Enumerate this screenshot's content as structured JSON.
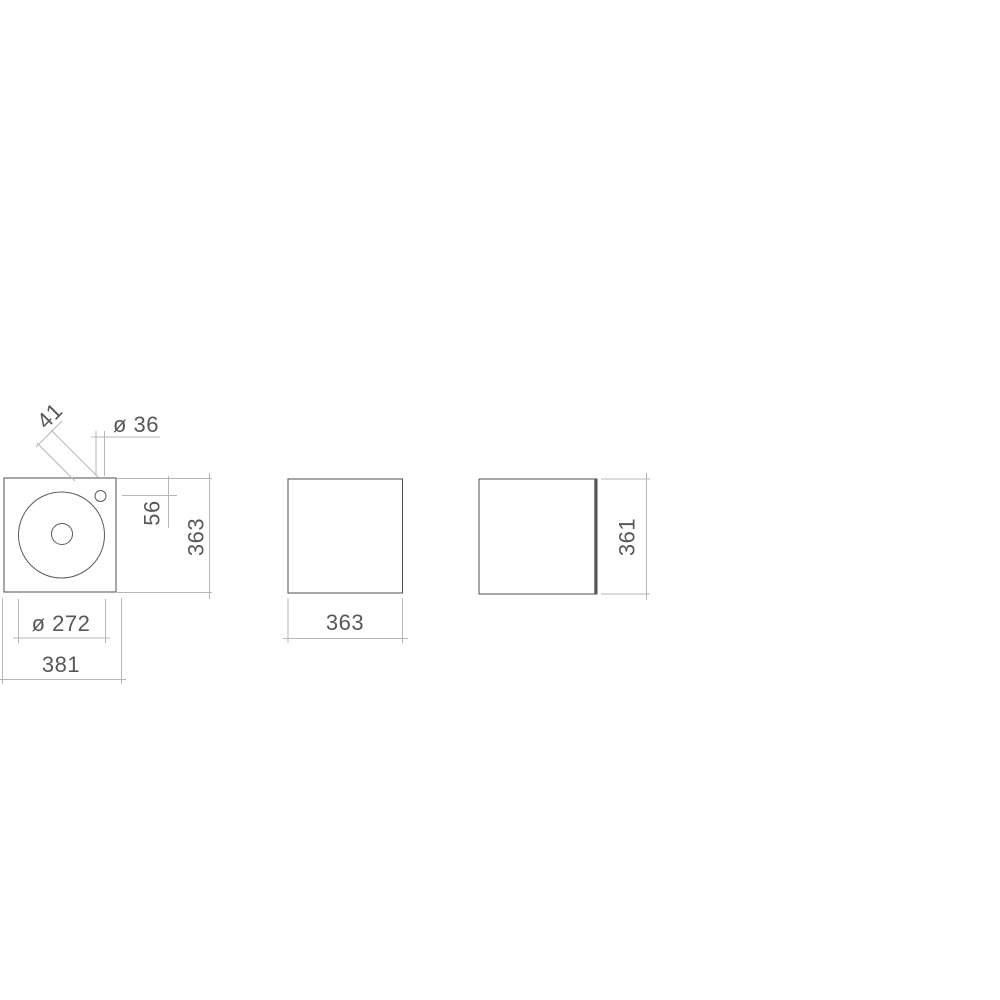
{
  "document": {
    "type": "technical dimension drawing",
    "subject": "square washbasin unit, three orthographic views",
    "views": {
      "top": {
        "name": "plan view with round basin, drain and tap hole",
        "dims": {
          "tap_hole_diagonal_offset": "41",
          "tap_hole_diameter": "ø 36",
          "tap_hole_from_rear_edge": "56",
          "depth": "363",
          "basin_diameter": "ø 272",
          "overall_width": "381"
        }
      },
      "front": {
        "name": "front elevation",
        "dims": {
          "width": "363"
        }
      },
      "side": {
        "name": "side elevation",
        "dims": {
          "height": "361"
        }
      }
    },
    "colors": {
      "background": "#ffffff",
      "outline": "#4f4f4f",
      "dimension_lines": "#b4b7b6",
      "text": "#585858"
    }
  }
}
